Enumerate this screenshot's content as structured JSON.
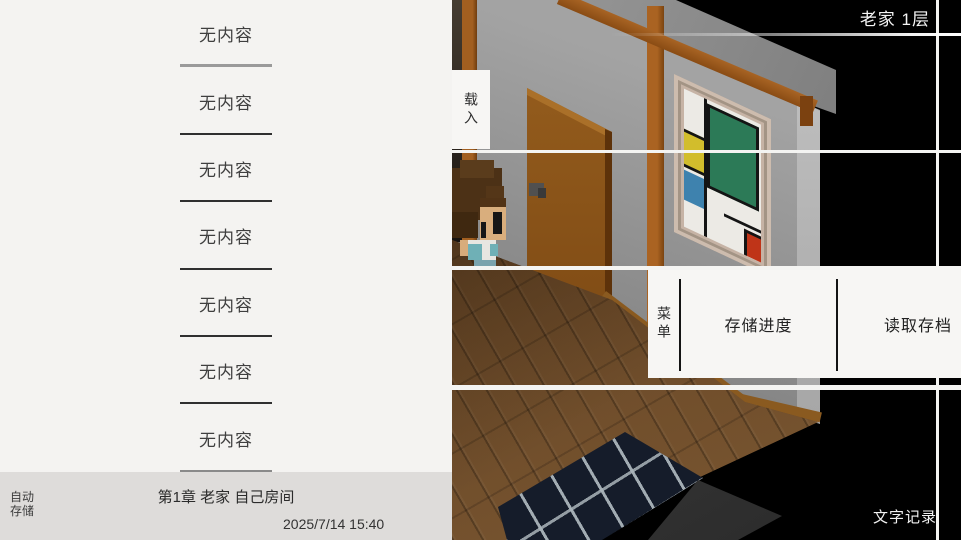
{
  "save_panel": {
    "slots": [
      {
        "label": "无内容"
      },
      {
        "label": "无内容"
      },
      {
        "label": "无内容"
      },
      {
        "label": "无内容"
      },
      {
        "label": "无内容"
      },
      {
        "label": "无内容"
      },
      {
        "label": "无内容"
      }
    ],
    "auto_save_entry": {
      "type_line1": "自动",
      "type_line2": "存储",
      "title": "第1章 老家 自己房间",
      "datetime": "2025/7/14 15:40"
    }
  },
  "hud": {
    "location": "老家 1层",
    "load": "载入",
    "menu": "菜单",
    "save_progress": "存储进度",
    "load_save": "读取存档",
    "text_log": "文字记录"
  },
  "scene_colors": {
    "wall": "#9a9a9a",
    "floor": "#6a4825",
    "door": "#8a5315",
    "wood_beam": "#a25f20",
    "rug": "#151c2a",
    "rug_pattern": "#aab4ba",
    "painting_green": "#2c7a57",
    "painting_yellow": "#d2bd2c",
    "painting_blue": "#3e82ae",
    "painting_red": "#bf3418",
    "ui_line": "#f4f4f2",
    "panel_bg": "#f4f3f1",
    "autosave_bar_bg": "#dedcda"
  }
}
